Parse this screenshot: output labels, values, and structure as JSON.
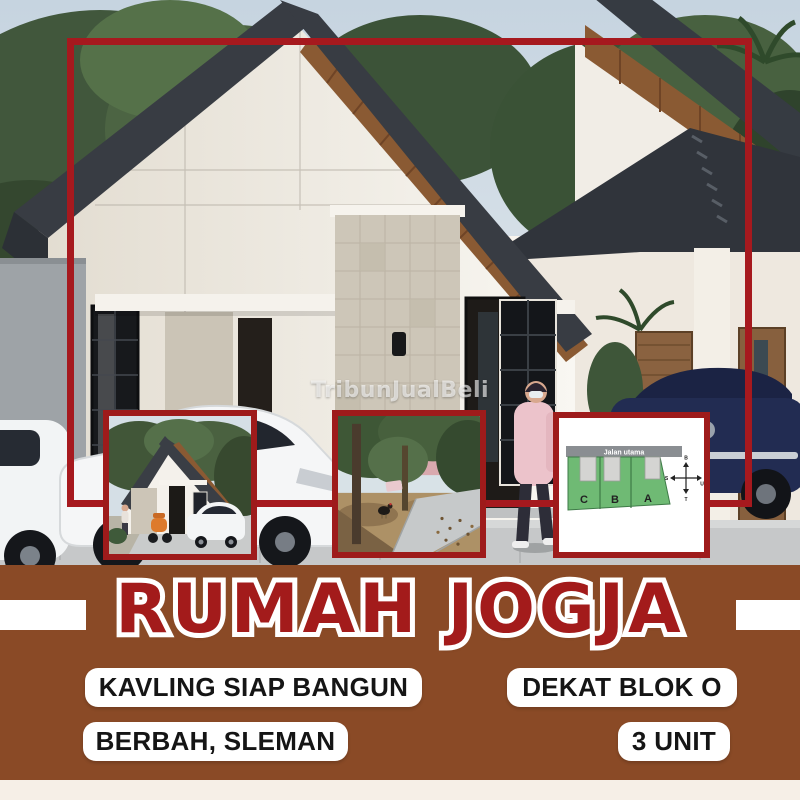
{
  "poster": {
    "title": "RUMAH JOGJA",
    "pills": [
      {
        "label": "KAVLING SIAP BANGUN"
      },
      {
        "label": "DEKAT BLOK O"
      },
      {
        "label": "BERBAH, SLEMAN"
      },
      {
        "label": "3 UNIT"
      }
    ],
    "colors": {
      "brown_bg": "#8A4A26",
      "frame_red": "#A6191E",
      "inset_border_red": "#9E1B1B",
      "title_red": "#A31B1B",
      "cream_strip": "#F6EFE7",
      "pill_bg": "#FFFFFF",
      "pill_text": "#151515"
    }
  },
  "watermark": {
    "text": "TribunJualBeli"
  },
  "site_plan": {
    "road_label": "Jalan utama",
    "plots": [
      "C",
      "B",
      "A"
    ],
    "plot_color": "#6FBA74",
    "compass": {
      "top": "B",
      "bottom": "T",
      "left": "S",
      "right": "U"
    }
  }
}
